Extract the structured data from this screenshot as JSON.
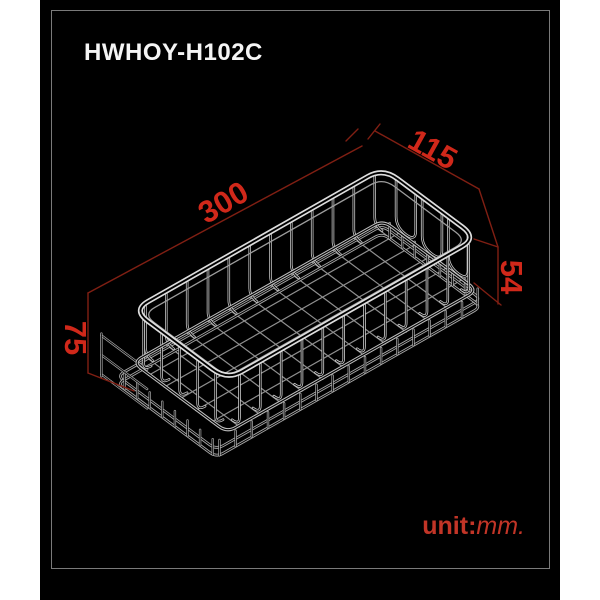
{
  "diagram": {
    "product_code": "HWHOY-H102C",
    "unit_prefix": "unit:",
    "unit_value": "mm.",
    "dimensions": {
      "length": "300",
      "width": "115",
      "depth": "54",
      "height": "75"
    }
  },
  "colors": {
    "background_black": "#000000",
    "margin_white": "#ffffff",
    "frame_border_gray": "#7a7a7a",
    "title_white": "#f5f5f5",
    "dimension_line_red": "#801f13",
    "dimension_label_red": "#d0281a",
    "unit_label_red": "#c23527",
    "wire_gray": "#c4c4c4"
  }
}
